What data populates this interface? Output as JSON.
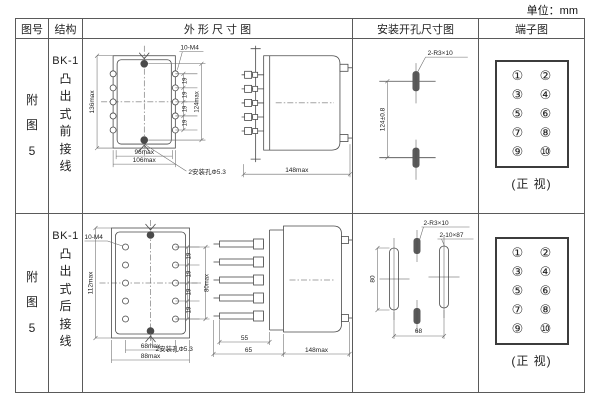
{
  "page": {
    "unit_label": "单位：mm"
  },
  "header": {
    "figure": "图号",
    "structure": "结构",
    "outline": "外 形 尺 寸 图",
    "mounting": "安装开孔尺寸图",
    "terminal": "端子图"
  },
  "rows": {
    "r1": {
      "figure_no": "附图5",
      "model": "BK-1",
      "structure_desc": "凸出式前接线",
      "front": {
        "height": "136max",
        "thread": "10-M4",
        "pitch": "19",
        "span": "124max",
        "width_inner": "96max",
        "width_outer": "106max",
        "hole_note": "2安装孔Φ5.3"
      },
      "side": {
        "depth": "148max"
      },
      "mounting": {
        "slot_note": "2-R3×10",
        "span": "124±0.8"
      },
      "terminal_caption": "(正 视)"
    },
    "r2": {
      "figure_no": "附图5",
      "model": "BK-1",
      "structure_desc": "凸出式后接线",
      "front": {
        "height": "112max",
        "thread": "10-M4",
        "pitch": "19",
        "span": "80max",
        "width_inner": "68max",
        "width_outer": "88max",
        "hole_note": "2安装孔Φ5.3"
      },
      "side": {
        "stud": "55",
        "offset": "65",
        "depth": "148max"
      },
      "mounting": {
        "slot_note": "2-R3×10",
        "slot_long": "2-10×87",
        "span_v": "80",
        "span_h": "68"
      },
      "terminal_caption": "(正 视)"
    }
  },
  "terminals": {
    "left": [
      "①",
      "③",
      "⑤",
      "⑦",
      "⑨"
    ],
    "right": [
      "②",
      "④",
      "⑥",
      "⑧",
      "⑩"
    ]
  }
}
